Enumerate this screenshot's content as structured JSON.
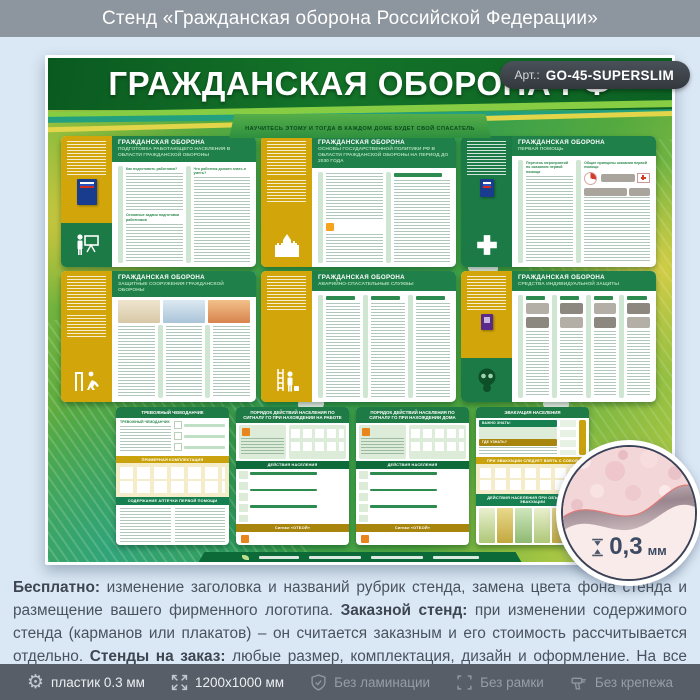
{
  "header_bar": {
    "title": "Стенд «Гражданская оборона Российской Федерации»"
  },
  "stand": {
    "art": {
      "label": "Арт.:",
      "value": "GO-45-SUPERSLIM"
    },
    "title": "ГРАЖДАНСКАЯ ОБОРОНА РФ",
    "motto": "НАУЧИТЕСЬ ЭТОМУ И ТОГДА В КАЖДОМ ДОМЕ БУДЕТ СВОЙ СПАСАТЕЛЬ",
    "panel_title": "ГРАЖДАНСКАЯ ОБОРОНА",
    "panels": [
      {
        "subtitle": "ПОДГОТОВКА РАБОТАЮЩЕГО НАСЕЛЕНИЯ В ОБЛАСТИ ГРАЖДАНСКОЙ ОБОРОНЫ",
        "icon": "presenter-pictogram",
        "headings": [
          "Как подготовить работника?",
          "Что работник должен знать и уметь?",
          "Основные задачи подготовки работников"
        ]
      },
      {
        "subtitle": "ОСНОВЫ ГОСУДАРСТВЕННОЙ ПОЛИТИКИ РФ В ОБЛАСТИ ГРАЖДАНСКОЙ ОБОРОНЫ НА ПЕРИОД ДО 2030 ГОДА",
        "icon": "kremlin-pictogram",
        "headings": []
      },
      {
        "subtitle": "ПЕРВАЯ ПОМОЩЬ",
        "icon": "medical-cross-pictogram",
        "headings": [
          "Перечень мероприятий по оказанию первой помощи",
          "Общие принципы оказания первой помощи"
        ]
      },
      {
        "subtitle": "ЗАЩИТНЫЕ СООРУЖЕНИЯ ГРАЖДАНСКОЙ ОБОРОНЫ",
        "icon": "shelter-pictogram",
        "headings": []
      },
      {
        "subtitle": "АВАРИЙНО-СПАСАТЕЛЬНЫЕ СЛУЖБЫ",
        "icon": "rescuer-pictogram",
        "headings": []
      },
      {
        "subtitle": "СРЕДСТВА ИНДИВИДУАЛЬНОЙ ЗАЩИТЫ",
        "icon": "gas-mask-pictogram",
        "headings": []
      }
    ],
    "mini_panels": [
      {
        "title": "ТРЕВОЖНЫЙ ЧЕМОДАНЧИК",
        "sub_label": "ТРЕВОЖНЫЙ ЧЕМОДАНЧИК",
        "sections": [
          "ПРИМЕРНАЯ КОМПЛЕКТАЦИЯ",
          "СОДЕРЖАНИЕ АПТЕЧКИ ПЕРВОЙ ПОМОЩИ"
        ]
      },
      {
        "title": "ПОРЯДОК ДЕЙСТВИЙ НАСЕЛЕНИЯ ПО СИГНАЛУ ГО ПРИ НАХОЖДЕНИИ НА РАБОТЕ",
        "sections": [
          "ДЕЙСТВИЯ НАСЕЛЕНИЯ",
          "Сигнал «ОТБОЙ»"
        ]
      },
      {
        "title": "ПОРЯДОК ДЕЙСТВИЙ НАСЕЛЕНИЯ ПО СИГНАЛУ ГО ПРИ НАХОЖДЕНИИ ДОМА",
        "sections": [
          "ДЕЙСТВИЯ НАСЕЛЕНИЯ",
          "Сигнал «ОТБОЙ»"
        ]
      },
      {
        "title": "ЭВАКУАЦИЯ НАСЕЛЕНИЯ",
        "sections": [
          "ВАЖНО ЗНАТЬ!",
          "ГДЕ УЗНАТЬ?",
          "ПРИ ЭВАКУАЦИИ СЛЕДУЕТ ВЗЯТЬ С СОБОЙ",
          "ДЕЙСТВИЯ НАСЕЛЕНИЯ ПРИ ОБЪЯВЛЕНИИ ЭВАКУАЦИИ"
        ]
      }
    ],
    "thickness": {
      "value": "0,3",
      "unit": "мм"
    }
  },
  "description": {
    "segments": [
      {
        "text": "Бесплатно:",
        "bold": true
      },
      {
        "text": " изменение заголовка и названий рубрик стенда, замена цвета фона стенда и размещение вашего фирменного логотипа. ",
        "bold": false
      },
      {
        "text": "Заказной стенд:",
        "bold": true
      },
      {
        "text": " при изменении содержимого стенда (карманов или плакатов) – он считается заказным и его стоимость рассчитывается отдельно. ",
        "bold": false
      },
      {
        "text": "Стенды на заказ:",
        "bold": true
      },
      {
        "text": " любые размер, комплектация, дизайн и оформление. На все изготовленные стенды даем 2 года гарантии. Выгодно, эстетично и надежно!",
        "bold": false
      }
    ]
  },
  "footer_bar": {
    "items": [
      {
        "icon": "gear-icon",
        "label": "пластик 0.3 мм",
        "muted": false
      },
      {
        "icon": "dimensions-icon",
        "label": "1200х1000 мм",
        "muted": false
      },
      {
        "icon": "shield-check-icon",
        "label": "Без ламинации",
        "muted": true
      },
      {
        "icon": "frame-corners-icon",
        "label": "Без рамки",
        "muted": true
      },
      {
        "icon": "fastening-icon",
        "label": "Без крепежа",
        "muted": true
      }
    ]
  },
  "colors": {
    "accent_green": "#1e7b46",
    "accent_yellow": "#d2a60a",
    "badge_bg": "#3f464c",
    "footer_bar_bg": "#575e67"
  }
}
